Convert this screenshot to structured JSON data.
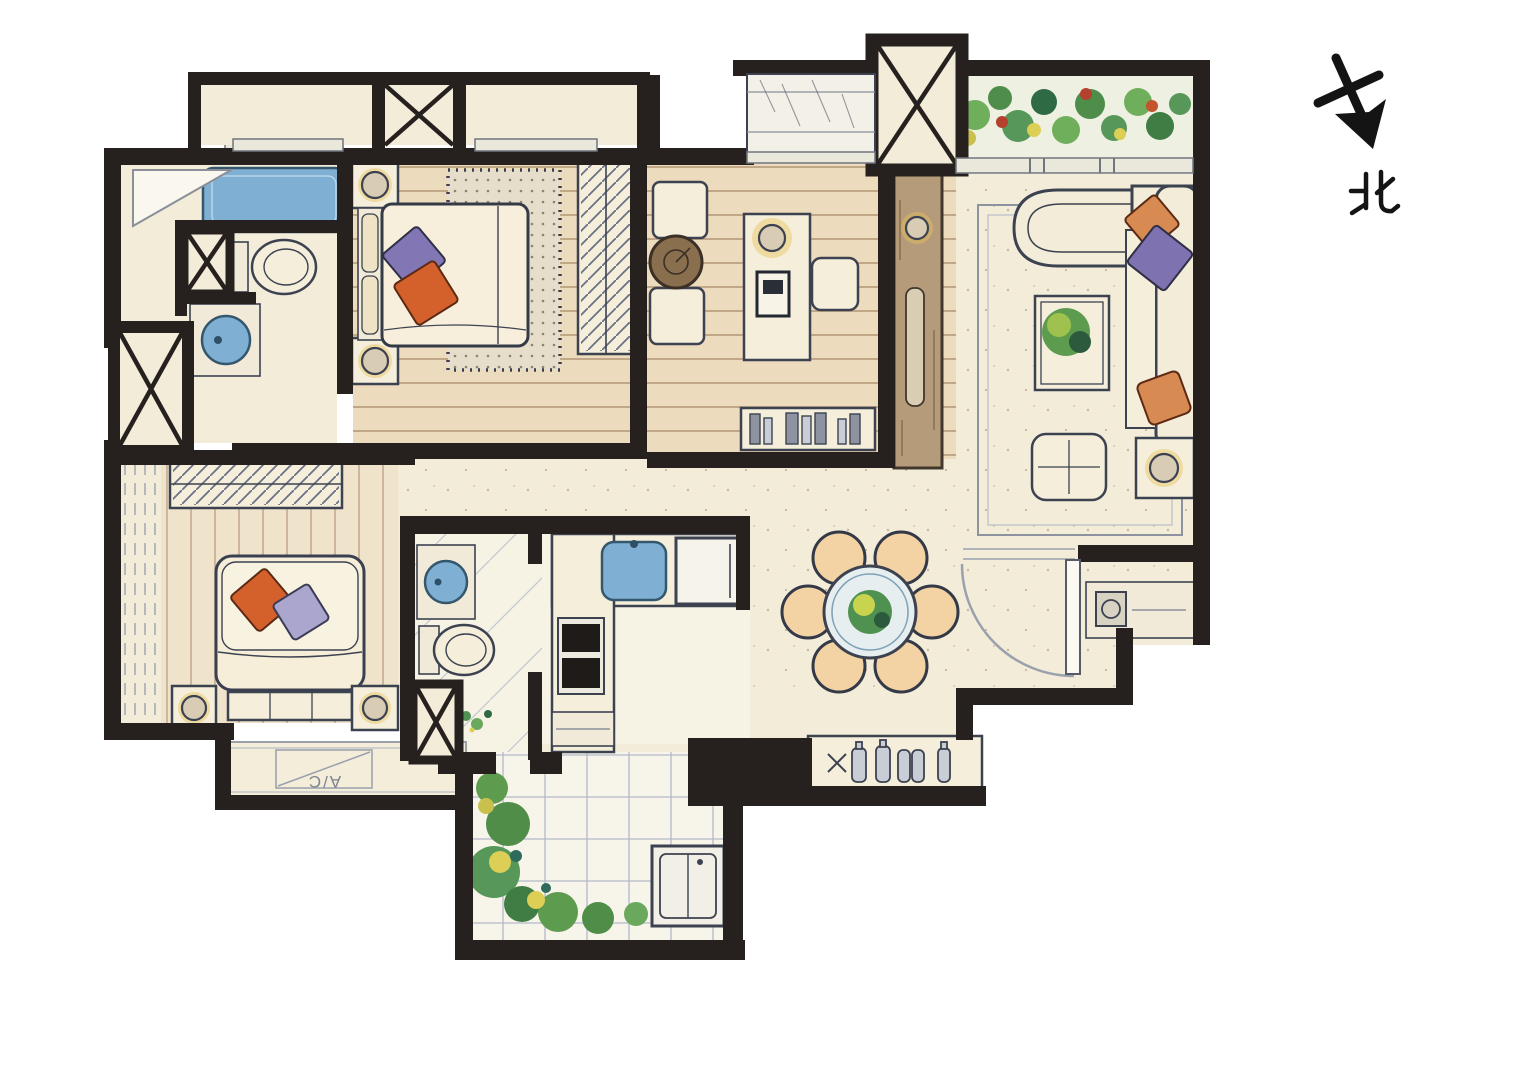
{
  "compass": {
    "label": "北"
  },
  "labels": {
    "ac": "A/C"
  },
  "palette": {
    "paper": "#ffffff",
    "wall": "#26211e",
    "outline": "#3c4250",
    "floor": "#f3ecd9",
    "floorWood": "#ecdbbc",
    "floorWoodLine": "#b29677",
    "tileLine": "#b3bac9",
    "water": "#7fb0d4",
    "waterDeep": "#35576e",
    "pillowOrange": "#d4602c",
    "pillowPurple": "#8277b4",
    "pillowLavender": "#aaa6ce",
    "plantGreen": "#4f9150",
    "plantLight": "#c8d44e",
    "woodDark": "#a98c66",
    "rugBase": "#e6ddca",
    "glow": "#e8c25a"
  }
}
